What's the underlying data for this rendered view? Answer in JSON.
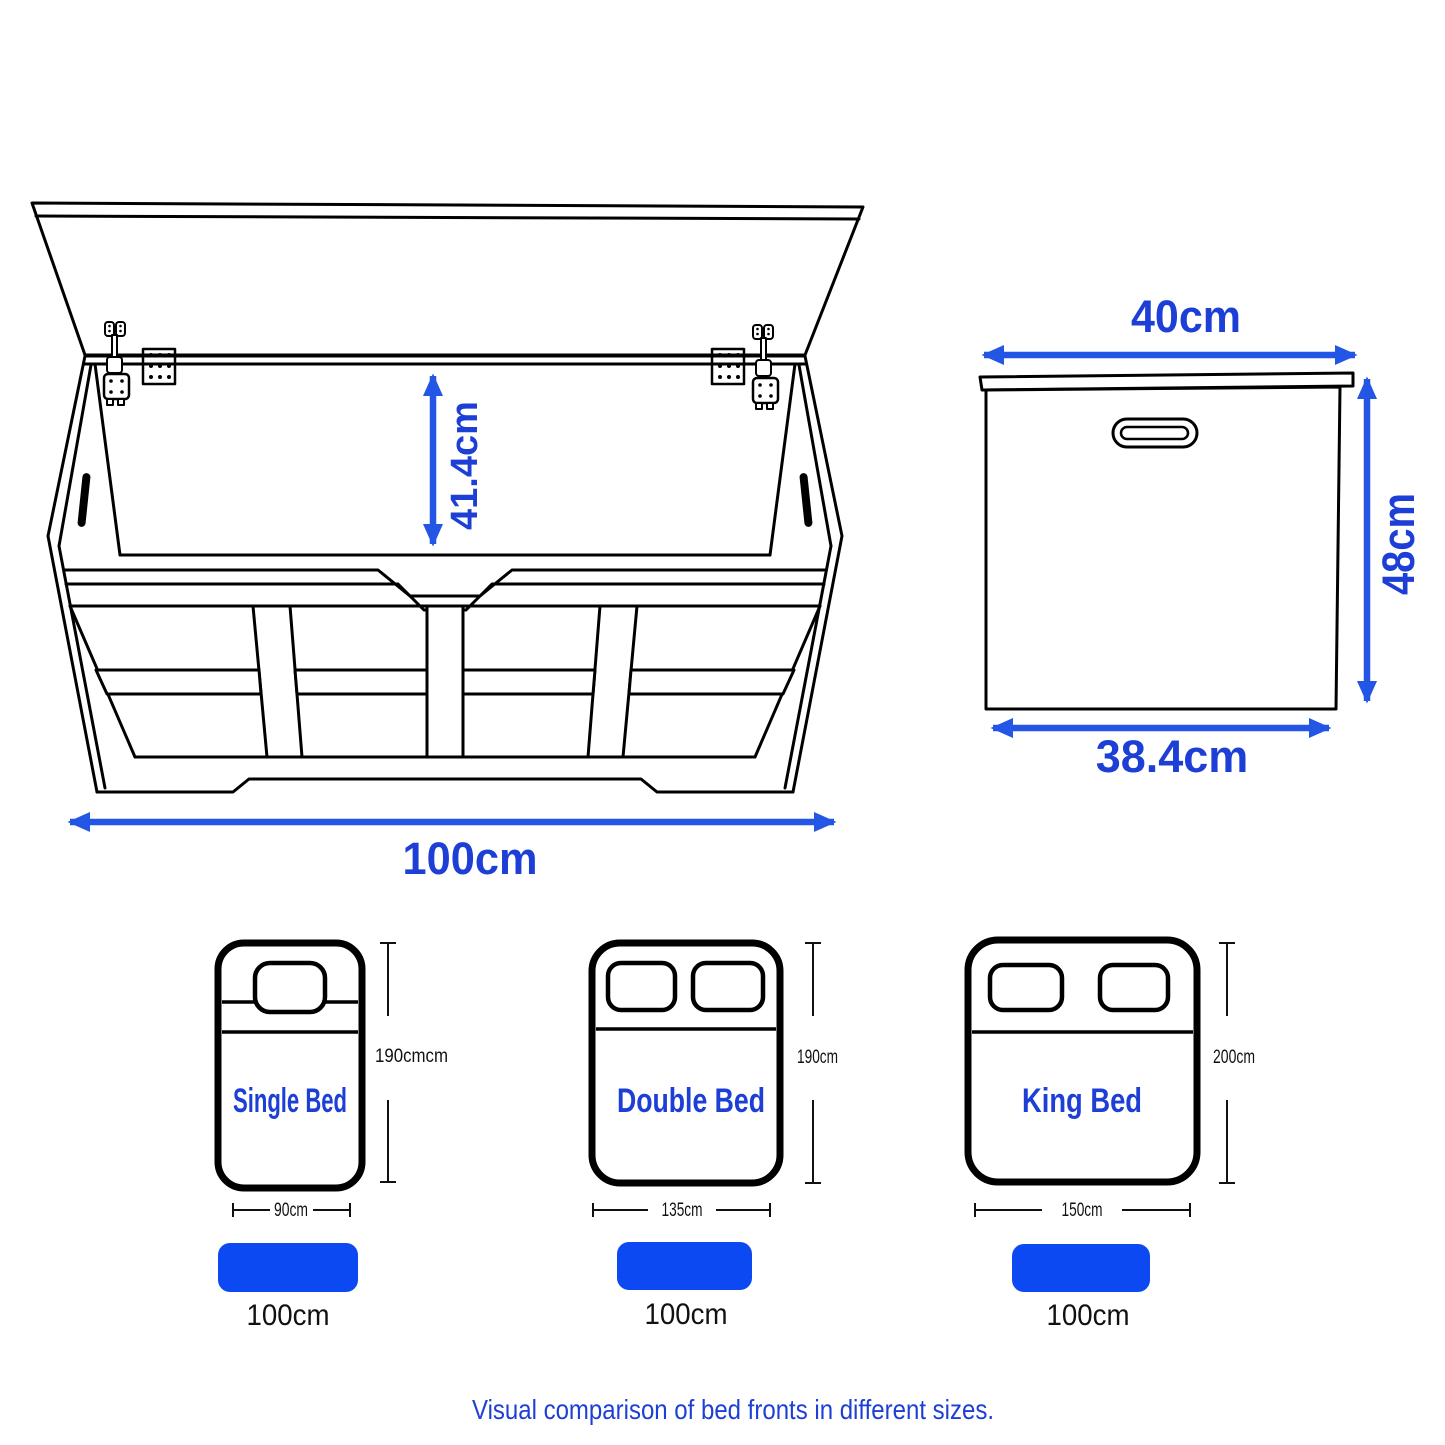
{
  "colors": {
    "label_blue": "#1d3fd6",
    "arrow_blue": "#2456e6",
    "bar_blue": "#0d49f2",
    "line_black": "#000000"
  },
  "front_view": {
    "inner_height": "41.4cm",
    "width": "100cm"
  },
  "side_view": {
    "top_width": "40cm",
    "height": "48cm",
    "bottom_width": "38.4cm"
  },
  "beds": [
    {
      "name": "Single Bed",
      "length": "190cmcm",
      "width": "90cm",
      "bench_width": "100cm"
    },
    {
      "name": "Double Bed",
      "length": "190cm",
      "width": "135cm",
      "bench_width": "100cm"
    },
    {
      "name": "King Bed",
      "length": "200cm",
      "width": "150cm",
      "bench_width": "100cm"
    }
  ],
  "caption": "Visual comparison of bed fronts in different sizes."
}
